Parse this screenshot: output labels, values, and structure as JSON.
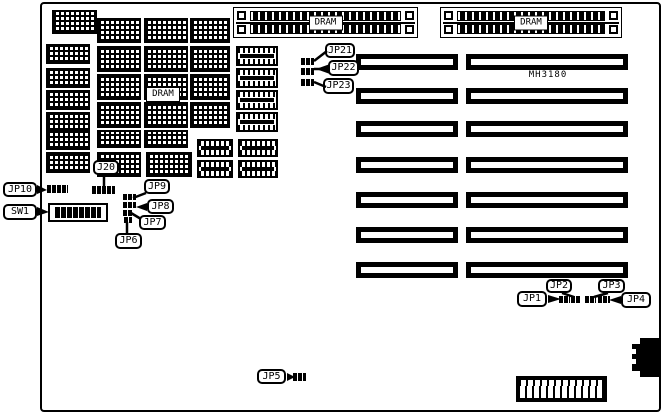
{
  "board": {
    "chipset_label": "MH3180",
    "dram_field_label": "DRAM"
  },
  "callouts": [
    {
      "label": "JP10",
      "box": [
        3,
        182,
        34,
        15
      ],
      "tri": "37,185 37,194 47,190"
    },
    {
      "label": "SW1",
      "box": [
        3,
        204,
        34,
        16
      ],
      "tri": "37,207 37,216 49,212"
    },
    {
      "label": "J20",
      "box": [
        93,
        160,
        26,
        15
      ],
      "line": [
        104,
        175,
        104,
        187
      ]
    },
    {
      "label": "JP9",
      "box": [
        144,
        179,
        26,
        15
      ],
      "line": [
        146,
        193,
        133,
        198
      ]
    },
    {
      "label": "JP8",
      "box": [
        147,
        199,
        27,
        15
      ],
      "tri": "147,203 147,211 136,207"
    },
    {
      "label": "JP7",
      "box": [
        139,
        215,
        27,
        15
      ],
      "line": [
        141,
        219,
        131,
        213
      ]
    },
    {
      "label": "JP6",
      "box": [
        115,
        233,
        27,
        16
      ],
      "line": [
        127,
        233,
        127,
        222
      ]
    },
    {
      "label": "JP5",
      "box": [
        257,
        369,
        29,
        15
      ],
      "tri": "287,373 287,381 295,377"
    },
    {
      "label": "JP21",
      "box": [
        325,
        43,
        30,
        15
      ],
      "line": [
        314,
        61,
        327,
        51
      ]
    },
    {
      "label": "JP22",
      "box": [
        328,
        60,
        31,
        16
      ],
      "tri": "330,64 330,74 316,69",
      "line": [
        314,
        69,
        321,
        69
      ]
    },
    {
      "label": "JP23",
      "box": [
        323,
        78,
        31,
        16
      ],
      "line": [
        314,
        82,
        326,
        87
      ]
    },
    {
      "label": "JP1",
      "box": [
        517,
        291,
        30,
        16
      ],
      "tri": "548,295 548,303 561,299"
    },
    {
      "label": "JP2",
      "box": [
        546,
        279,
        26,
        14
      ],
      "line": [
        562,
        293,
        574,
        297
      ]
    },
    {
      "label": "JP3",
      "box": [
        598,
        279,
        27,
        14
      ],
      "line": [
        608,
        293,
        594,
        297
      ]
    },
    {
      "label": "JP4",
      "box": [
        621,
        292,
        30,
        16
      ],
      "tri": "621,296 621,304 609,300"
    }
  ],
  "figure": {
    "chips": [
      [
        52,
        10,
        45,
        24,
        "g"
      ],
      [
        46,
        44,
        44,
        20,
        "g"
      ],
      [
        46,
        68,
        44,
        20,
        "g"
      ],
      [
        46,
        90,
        44,
        20,
        "g"
      ],
      [
        46,
        112,
        44,
        20,
        "g"
      ],
      [
        46,
        131,
        44,
        19,
        "g"
      ],
      [
        46,
        152,
        44,
        21,
        "g"
      ],
      [
        97,
        18,
        44,
        25,
        "g"
      ],
      [
        97,
        46,
        44,
        26,
        "g"
      ],
      [
        97,
        74,
        44,
        26,
        "g"
      ],
      [
        97,
        102,
        44,
        26,
        "g"
      ],
      [
        97,
        130,
        44,
        18,
        "g"
      ],
      [
        97,
        152,
        44,
        25,
        "g"
      ],
      [
        144,
        18,
        44,
        25,
        "g"
      ],
      [
        144,
        46,
        44,
        26,
        "g"
      ],
      [
        144,
        74,
        44,
        26,
        "g"
      ],
      [
        144,
        102,
        44,
        26,
        "g"
      ],
      [
        144,
        130,
        44,
        18,
        "g"
      ],
      [
        146,
        152,
        46,
        25,
        "g"
      ],
      [
        190,
        18,
        40,
        25,
        "g"
      ],
      [
        190,
        46,
        40,
        26,
        "g"
      ],
      [
        190,
        74,
        40,
        26,
        "g"
      ],
      [
        190,
        102,
        40,
        26,
        "g"
      ],
      [
        197,
        139,
        36,
        18,
        "d"
      ],
      [
        197,
        160,
        36,
        18,
        "d"
      ],
      [
        236,
        46,
        42,
        20,
        "d"
      ],
      [
        236,
        68,
        42,
        20,
        "d"
      ],
      [
        236,
        90,
        42,
        20,
        "d"
      ],
      [
        236,
        112,
        42,
        20,
        "d"
      ],
      [
        238,
        139,
        40,
        18,
        "d"
      ],
      [
        238,
        160,
        40,
        18,
        "d"
      ]
    ],
    "slot_rows": [
      54,
      88,
      121,
      157,
      192,
      227,
      262
    ],
    "slot_cols": {
      "left": [
        356,
        102
      ],
      "right": [
        466,
        162
      ],
      "h": 16
    },
    "simms": [
      {
        "x": 233,
        "y": 7,
        "w": 185,
        "h": 31,
        "label": "DRAM"
      },
      {
        "x": 440,
        "y": 7,
        "w": 182,
        "h": 31,
        "label": "DRAM"
      }
    ],
    "pins": [
      [
        47,
        185,
        21,
        8
      ],
      [
        92,
        186,
        23,
        8
      ],
      [
        123,
        194,
        13,
        6
      ],
      [
        123,
        202,
        13,
        6
      ],
      [
        123,
        210,
        10,
        6
      ],
      [
        124,
        217,
        8,
        6
      ],
      [
        293,
        373,
        13,
        8
      ],
      [
        301,
        58,
        13,
        7
      ],
      [
        301,
        68,
        13,
        7
      ],
      [
        301,
        79,
        13,
        7
      ],
      [
        559,
        296,
        11,
        7
      ],
      [
        571,
        296,
        10,
        7
      ],
      [
        585,
        296,
        11,
        7
      ],
      [
        598,
        296,
        12,
        7
      ]
    ],
    "power": {
      "teeth": 12
    },
    "keyboard": {
      "notches": 2
    }
  }
}
